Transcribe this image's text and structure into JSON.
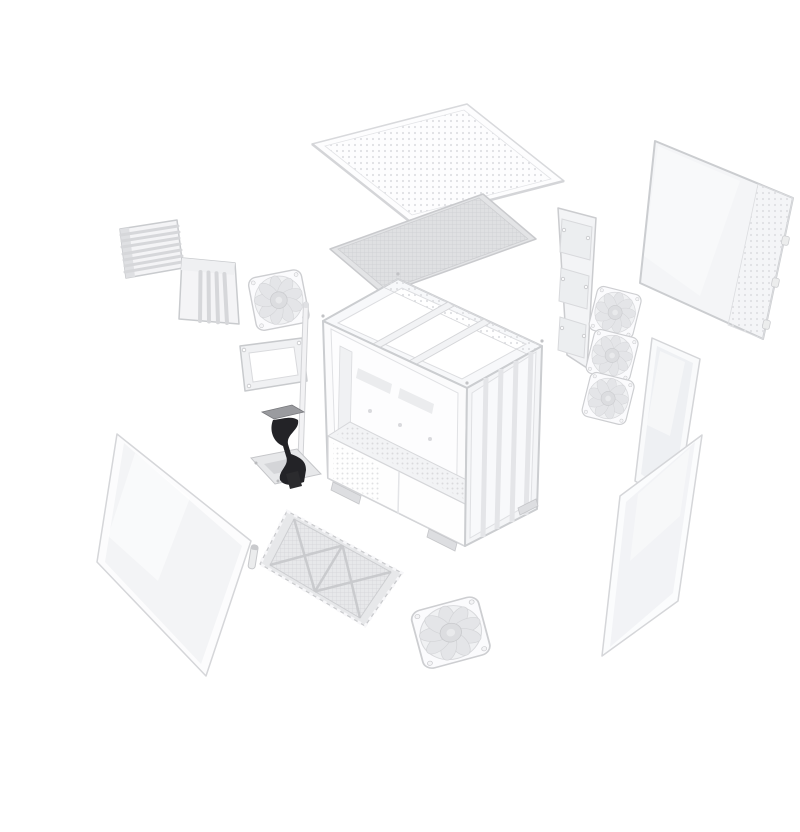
{
  "meta": {
    "title": "Exploded view render of a white mid-tower PC case on a plain white background",
    "background": "#ffffff",
    "visible_text": ""
  },
  "palette": {
    "background": "#ffffff",
    "panel_white": "#fafafb",
    "panel_fill": "#f4f5f7",
    "outline_gray": "#cbcdd0",
    "filter_gray": "#dfe0e2",
    "glass_tint": "#f2f3f6",
    "fan_blade_gray": "#e4e5e8",
    "riser_black": "#232327",
    "connector_metal": "#9a9b9f"
  },
  "components": [
    {
      "id": "top-panel",
      "label": "Perforated steel top panel"
    },
    {
      "id": "top-dust-filter",
      "label": "Magnetic top dust filter"
    },
    {
      "id": "side-panel-steel",
      "label": "Steel side panel with ventilated front strip"
    },
    {
      "id": "fan-mount-rail",
      "label": "Removable fan mounting rail"
    },
    {
      "id": "fan-stack",
      "label": "Three 120 mm cooling fans (side)"
    },
    {
      "id": "front-glass-column",
      "label": "Front corner tempered glass strip"
    },
    {
      "id": "side-panel-glass",
      "label": "Tempered glass side panel"
    },
    {
      "id": "chassis",
      "label": "Main chassis frame with PSU shroud"
    },
    {
      "id": "expansion-slot-bracket",
      "label": "Expansion slot cover bracket"
    },
    {
      "id": "vertical-gpu-bracket",
      "label": "Vertical GPU slot bracket"
    },
    {
      "id": "left-fan",
      "label": "120 mm cooling fan (rear)"
    },
    {
      "id": "psu-mount-frame",
      "label": "PSU mounting frame"
    },
    {
      "id": "support-rod",
      "label": "Panel support rod"
    },
    {
      "id": "riser-cable",
      "label": "PCIe riser cable with bracket"
    },
    {
      "id": "front-glass-panel",
      "label": "Tempered glass front panel"
    },
    {
      "id": "glass-pin",
      "label": "Panel alignment pin"
    },
    {
      "id": "bottom-dust-filter",
      "label": "Bottom dust filter with cross brace"
    },
    {
      "id": "bottom-fan",
      "label": "120 mm cooling fan (bottom)"
    }
  ]
}
